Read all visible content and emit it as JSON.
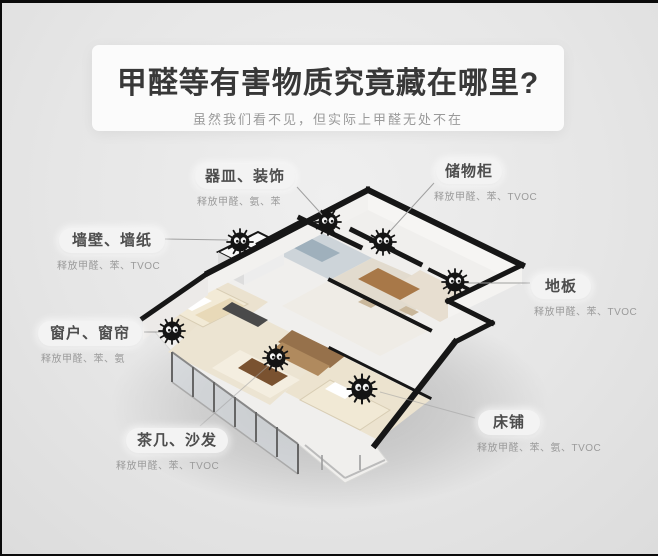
{
  "header": {
    "title": "甲醛等有害物质究竟藏在哪里?",
    "subtitle": "虽然我们看不见，但实际上甲醛无处不在"
  },
  "callouts": [
    {
      "name": "器皿、装饰",
      "detail": "释放甲醛、氨、苯"
    },
    {
      "name": "储物柜",
      "detail": "释放甲醛、苯、TVOC"
    },
    {
      "name": "墙壁、墙纸",
      "detail": "释放甲醛、苯、TVOC"
    },
    {
      "name": "地板",
      "detail": "释放甲醛、苯、TVOC"
    },
    {
      "name": "窗户、窗帘",
      "detail": "释放甲醛、苯、氨"
    },
    {
      "name": "茶几、沙发",
      "detail": "释放甲醛、苯、TVOC"
    },
    {
      "name": "床铺",
      "detail": "释放甲醛、苯、氨、TVOC"
    }
  ],
  "colors": {
    "background": "#e6e6e6",
    "title_panel": "#fbfbfb",
    "title_text": "#383838",
    "subtitle_text": "#9a9a9a",
    "callout_text": "#4d4d4d",
    "detail_text": "#9b9b9b",
    "sprite_body": "#141414",
    "wall_cap": "#161616"
  }
}
